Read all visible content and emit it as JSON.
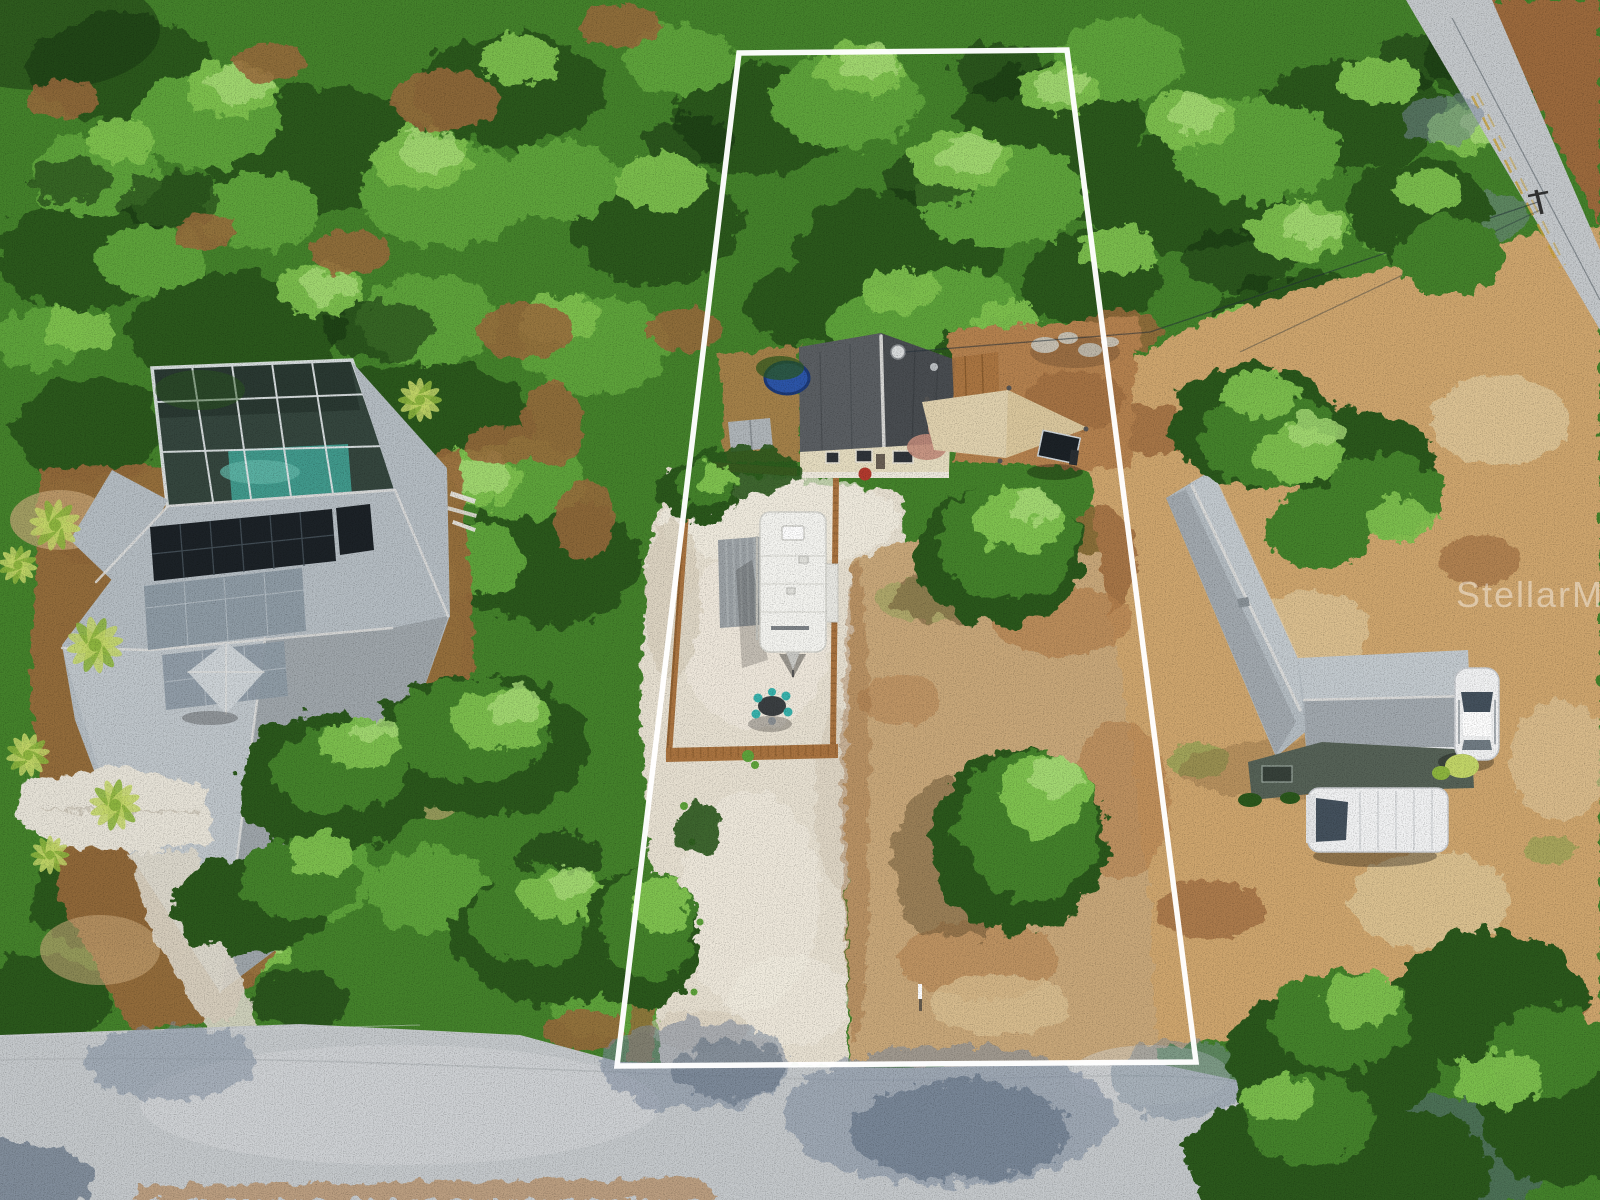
{
  "watermark": {
    "text": "StellarMLS"
  },
  "palette": {
    "canopy": "#44822b",
    "canopyDk": "#2b581c",
    "canopyShadow": "#173312",
    "canopyLt": "#5ea33b",
    "canopyBr": "#7fc24f",
    "canopyHi": "#a9dc78",
    "mulch": "#9c6a3d",
    "dirt": "#b5824f",
    "dirtLt": "#cfa66e",
    "dryGrass": "#c9a87a",
    "dryLt": "#ddc597",
    "gravel": "#e8e1d2",
    "gravelLt": "#f4efe3",
    "gravelSh": "#d5cbb8",
    "concrete": "#e7e3d8",
    "road": "#c5c9cc",
    "roadLt": "#d7dadc",
    "roadSh": "#7d8da0",
    "roadShDk": "#54657a",
    "roofA": "#5b5f63",
    "roofB": "#494d51",
    "ridge": "#dfdfdd",
    "wall": "#e6ddc1",
    "red": "#b23a2e",
    "lroof": "#b5bdc3",
    "lroofLt": "#cdd3d7",
    "cage": "#35463e",
    "frameW": "#e4e9eb",
    "pool": "#41998c",
    "solar": "#1c2227",
    "solarG": "#8e9ba5",
    "fence": "#aa7440",
    "fenceDk": "#7b5126",
    "rv": "#f5f5f1",
    "carport": "#9ba1a5",
    "sail": "#dbc89e",
    "teal": "#38b2ac",
    "patio": "#c38d7c",
    "car": "#f2f3f4",
    "glass": "#44515d",
    "wallGreen": "#566257",
    "white": "#ffffff",
    "palm": "#8db53f",
    "palmLt": "#c3d668",
    "tramp": "#2c55a8",
    "yline": "#c9a23a"
  }
}
